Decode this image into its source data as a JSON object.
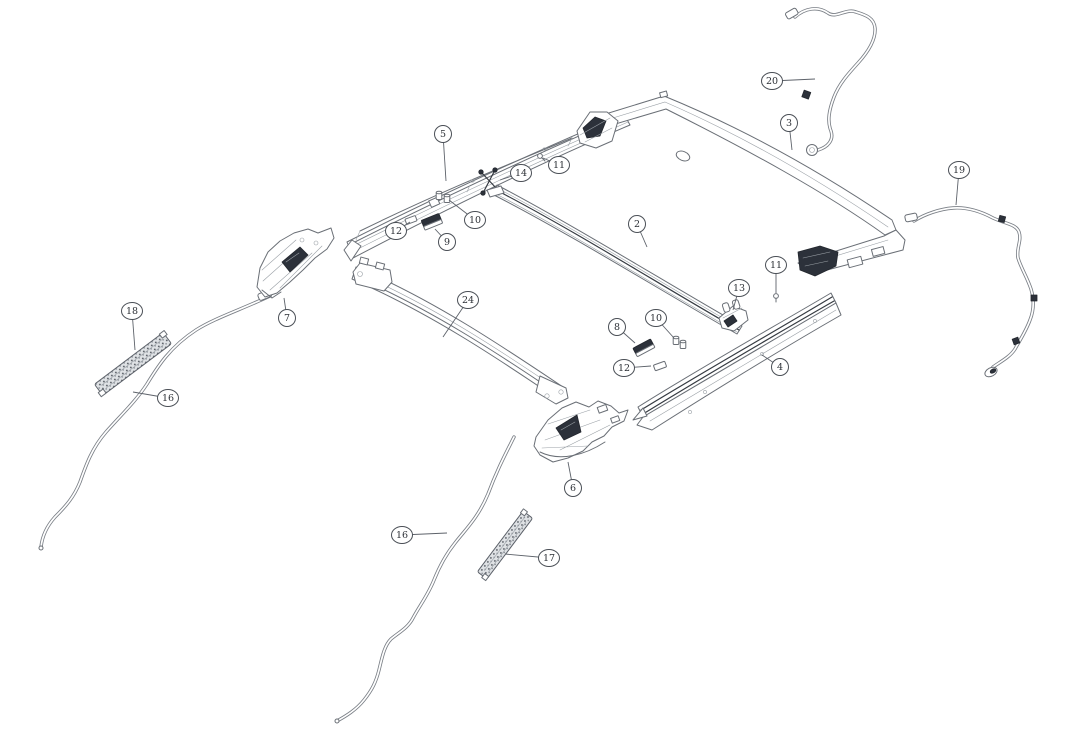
{
  "page": {
    "background": "#ffffff",
    "width": 1080,
    "height": 732
  },
  "diagram": {
    "figure_type": "exploded-parts-diagram",
    "description": "Sunroof / roof frame assembly exploded view with numbered part callouts",
    "colors": {
      "line": "#6a6f76",
      "dark_part": "#2c313a",
      "callout_stroke": "#4a4f56",
      "callout_text": "#2b2f35",
      "background": "#ffffff"
    },
    "callout_labels_visible": [
      "2",
      "3",
      "4",
      "5",
      "6",
      "7",
      "8",
      "9",
      "10",
      "11",
      "12",
      "13",
      "14",
      "16",
      "17",
      "18",
      "19",
      "20",
      "24"
    ],
    "callouts": [
      {
        "label": "5",
        "cx": 443,
        "cy": 134,
        "tx": 446,
        "ty": 181
      },
      {
        "label": "11",
        "cx": 559,
        "cy": 165,
        "tx": 543,
        "ty": 158
      },
      {
        "label": "14",
        "cx": 521,
        "cy": 173,
        "tx": 500,
        "ty": 180
      },
      {
        "label": "10",
        "cx": 475,
        "cy": 220,
        "tx": 449,
        "ty": 200
      },
      {
        "label": "12",
        "cx": 396,
        "cy": 231,
        "tx": 410,
        "ty": 222
      },
      {
        "label": "9",
        "cx": 447,
        "cy": 242,
        "tx": 435,
        "ty": 229
      },
      {
        "label": "2",
        "cx": 637,
        "cy": 224,
        "tx": 647,
        "ty": 247
      },
      {
        "label": "3",
        "cx": 789,
        "cy": 123,
        "tx": 792,
        "ty": 150
      },
      {
        "label": "20",
        "cx": 772,
        "cy": 81,
        "tx": 815,
        "ty": 79
      },
      {
        "label": "19",
        "cx": 959,
        "cy": 170,
        "tx": 956,
        "ty": 205
      },
      {
        "label": "11",
        "cx": 776,
        "cy": 265,
        "tx": 776,
        "ty": 293
      },
      {
        "label": "13",
        "cx": 739,
        "cy": 288,
        "tx": 733,
        "ty": 310
      },
      {
        "label": "7",
        "cx": 287,
        "cy": 318,
        "tx": 284,
        "ty": 298
      },
      {
        "label": "18",
        "cx": 132,
        "cy": 311,
        "tx": 135,
        "ty": 350
      },
      {
        "label": "24",
        "cx": 468,
        "cy": 300,
        "tx": 443,
        "ty": 337
      },
      {
        "label": "8",
        "cx": 617,
        "cy": 327,
        "tx": 635,
        "ty": 343
      },
      {
        "label": "10",
        "cx": 656,
        "cy": 318,
        "tx": 674,
        "ty": 338
      },
      {
        "label": "12",
        "cx": 624,
        "cy": 368,
        "tx": 651,
        "ty": 366
      },
      {
        "label": "4",
        "cx": 780,
        "cy": 367,
        "tx": 762,
        "ty": 355
      },
      {
        "label": "16",
        "cx": 168,
        "cy": 398,
        "tx": 133,
        "ty": 392
      },
      {
        "label": "6",
        "cx": 573,
        "cy": 488,
        "tx": 568,
        "ty": 462
      },
      {
        "label": "16",
        "cx": 402,
        "cy": 535,
        "tx": 447,
        "ty": 533
      },
      {
        "label": "17",
        "cx": 549,
        "cy": 558,
        "tx": 505,
        "ty": 554
      }
    ]
  }
}
